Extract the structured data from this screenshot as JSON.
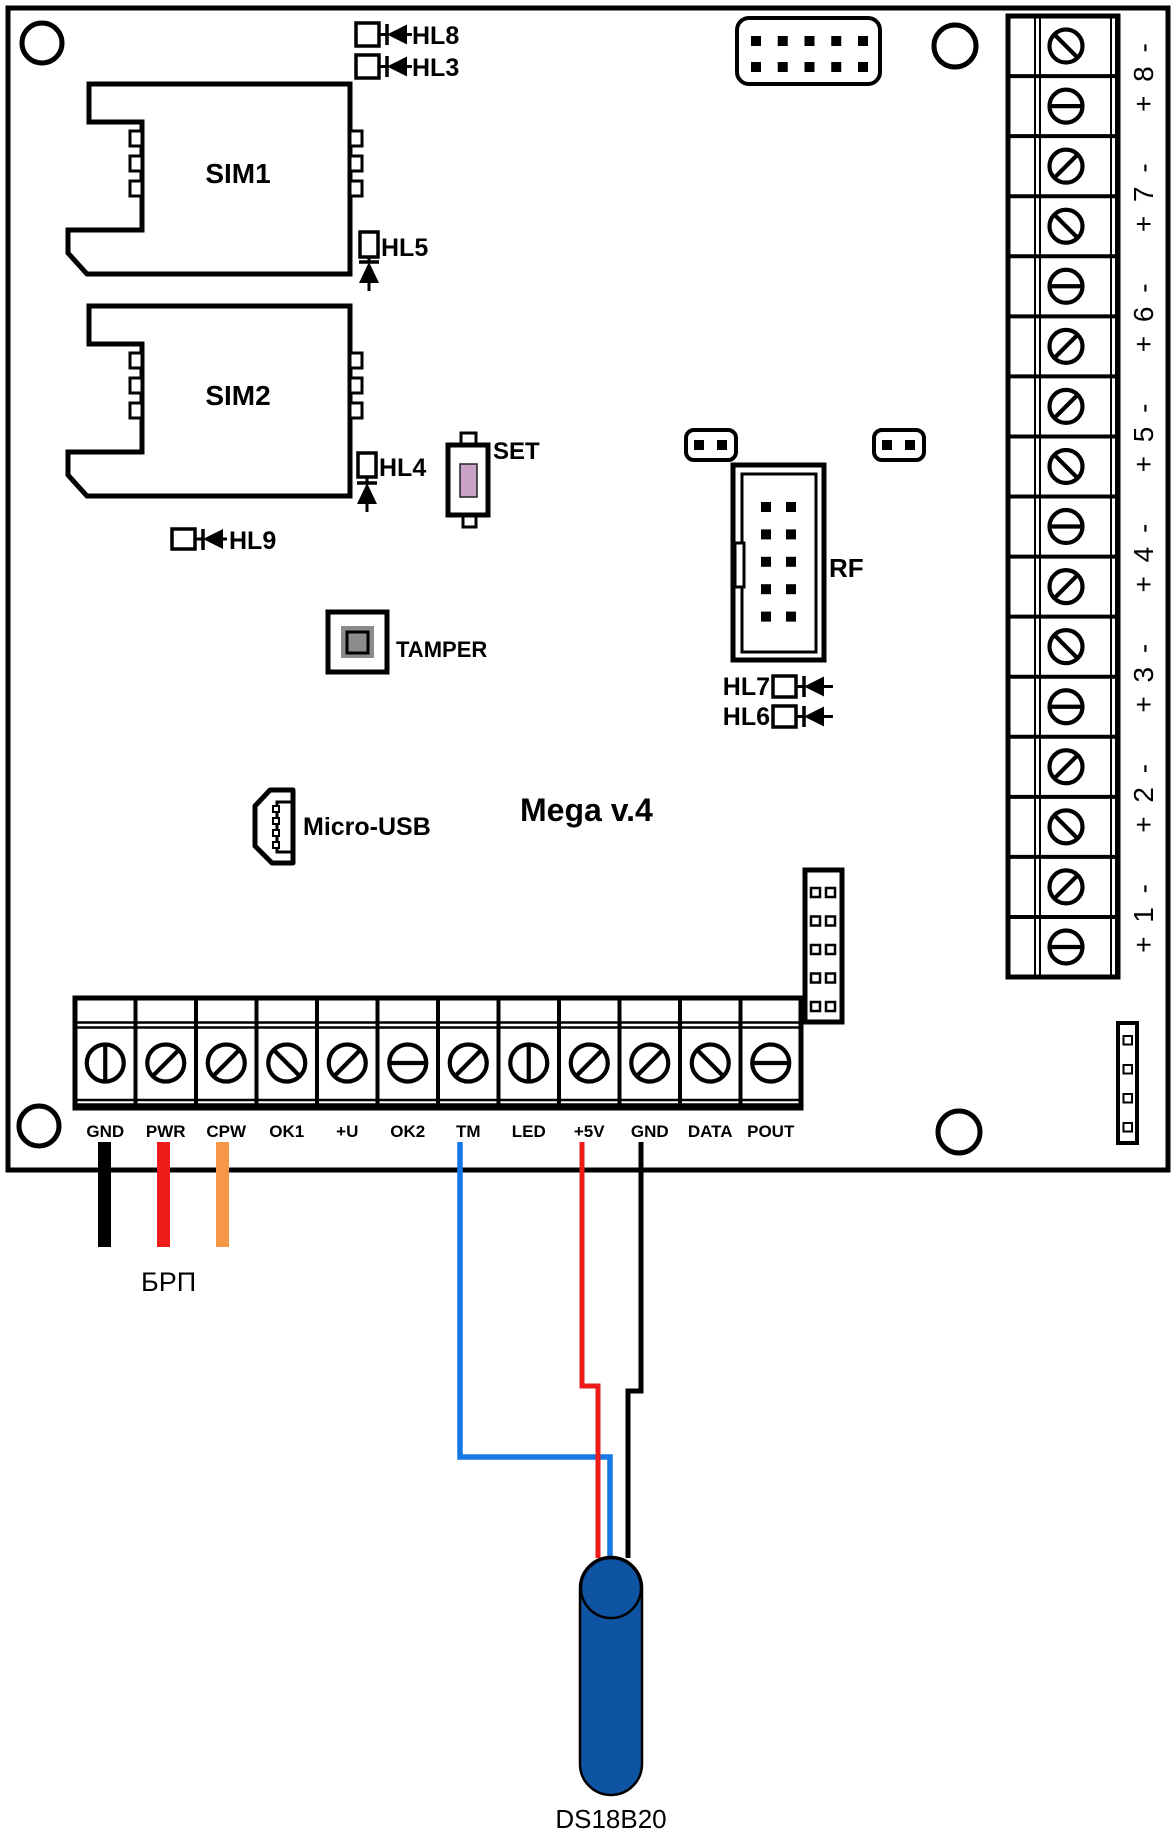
{
  "title": "Mega v.4",
  "sim": {
    "sim1": "SIM1",
    "sim2": "SIM2"
  },
  "leds": {
    "hl8": "HL8",
    "hl3": "HL3",
    "hl5": "HL5",
    "hl4": "HL4",
    "hl9": "HL9",
    "hl7": "HL7",
    "hl6": "HL6"
  },
  "buttons": {
    "set": "SET",
    "tamper": "TAMPER"
  },
  "connectors": {
    "micro_usb": "Micro-USB",
    "rf": "RF"
  },
  "right_terminal": {
    "labels": [
      "+ 8 -",
      "+ 7 -",
      "+ 6 -",
      "+ 5 -",
      "+ 4 -",
      "+ 3 -",
      "+ 2 -",
      "+ 1 -"
    ]
  },
  "bottom_terminal": {
    "labels": [
      "GND",
      "PWR",
      "CPW",
      "OK1",
      "+U",
      "OK2",
      "TM",
      "LED",
      "+5V",
      "GND",
      "DATA",
      "POUT"
    ]
  },
  "external": {
    "psu_label": "БРП",
    "sensor_label": "DS18B20"
  },
  "colors": {
    "line": "#000000",
    "wire_black": "#000000",
    "wire_red": "#ee1b1b",
    "wire_orange": "#f79646",
    "wire_blue": "#1778e5",
    "sensor_blue": "#0f54a3",
    "set_actuator_pink": "#c9a2c6",
    "tamper_gray": "#8c8c8c"
  }
}
